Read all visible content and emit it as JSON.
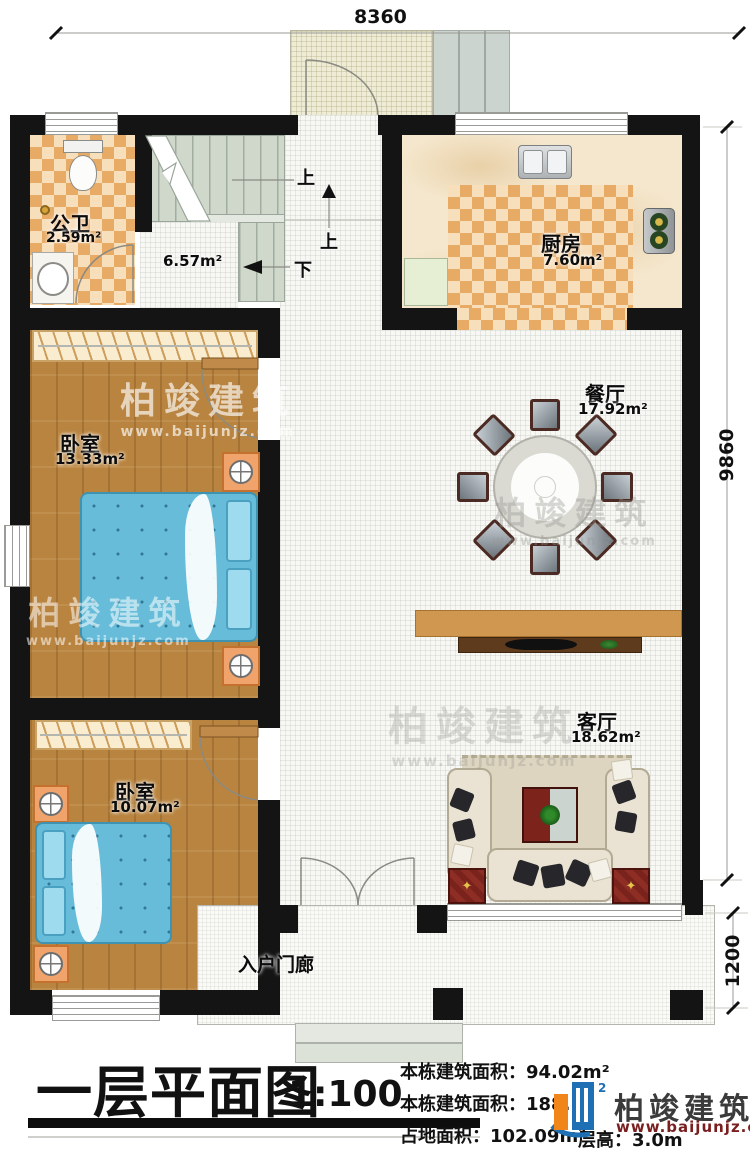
{
  "dimensions": {
    "top": "8360",
    "right_upper": "9860",
    "right_lower": "1200"
  },
  "rooms": {
    "bathroom": {
      "name": "公卫",
      "area": "2.59m²"
    },
    "stair_hall": {
      "area": "6.57m²"
    },
    "kitchen": {
      "name": "厨房",
      "area": "7.60m²"
    },
    "bedroom1": {
      "name": "卧室",
      "area": "13.33m²"
    },
    "dining": {
      "name": "餐厅",
      "area": "17.92m²"
    },
    "living": {
      "name": "客厅",
      "area": "18.62m²"
    },
    "bedroom2": {
      "name": "卧室",
      "area": "10.07m²"
    },
    "porch": {
      "name": "入户门廊"
    }
  },
  "stairs": {
    "up1": "上",
    "up2": "上",
    "down": "下"
  },
  "title_block": {
    "title": "一层平面图",
    "scale": "1:100",
    "info_line1": "本栋建筑面积：94.02m²",
    "info_line2": "本栋建筑面积：188.",
    "info_line3": "占地面积：102.09m²",
    "info_line4": "层高：3.0m"
  },
  "branding": {
    "name": "柏竣建筑",
    "website": "www.baijunjz.com"
  }
}
